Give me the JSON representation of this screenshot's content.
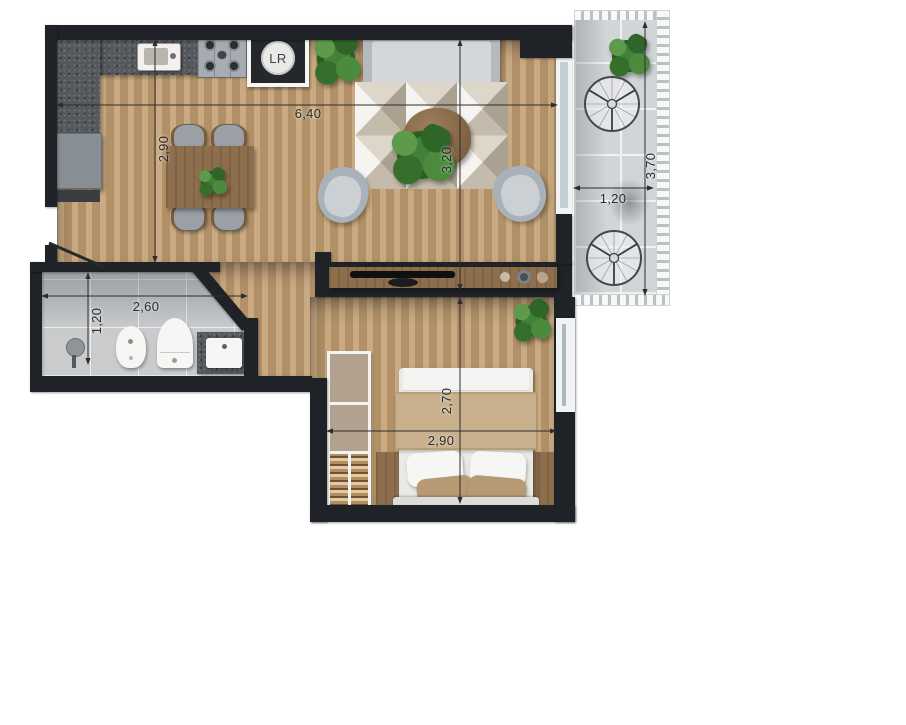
{
  "floor_plan": {
    "washer_label": "LR",
    "dimensions": {
      "living_width": "6,40",
      "kitchen_depth": "2,90",
      "living_depth": "3,20",
      "balcony_width": "1,20",
      "balcony_depth": "3,70",
      "bathroom_width": "2,60",
      "bathroom_depth": "1,20",
      "bedroom_depth": "2,70",
      "bedroom_width": "2,90"
    },
    "palette": {
      "wall": "#1f2327",
      "wood_floor": "#c09e73",
      "bathroom_tile": "#c9cbcd",
      "balcony_tile": "#d2d5d7",
      "counter_granite": "#54575b",
      "upholstery": "#b3b9bf",
      "bed_blanket": "#c9b08d",
      "plant_green": "#428238"
    }
  }
}
